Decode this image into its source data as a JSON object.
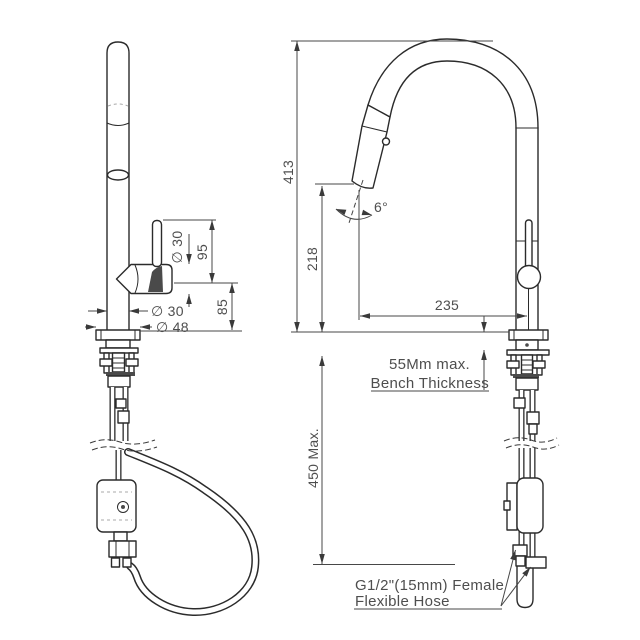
{
  "drawing": {
    "type": "technical-dimension-diagram",
    "subject": "pull-down kitchen sink mixer tap, two side views with dimensions",
    "colors": {
      "line": "#2b2b2b",
      "dim_line": "#474747",
      "text": "#4e4e4e",
      "background": "#ffffff"
    },
    "labels": {
      "left": {
        "handle_dia": "∅ 30",
        "handle_height": "95",
        "spout_height": "85",
        "body_dia": "∅ 30",
        "base_dia": "∅ 48"
      },
      "right": {
        "overall_height": "413",
        "outlet_height": "218",
        "spout_reach": "235",
        "spray_angle": "6°",
        "bench_note1": "55Mm max.",
        "bench_note2": "Bench Thickness",
        "under_bench": "450 Max.",
        "hose_note1": "G1/2\"(15mm) Female",
        "hose_note2": "Flexible Hose"
      }
    }
  }
}
